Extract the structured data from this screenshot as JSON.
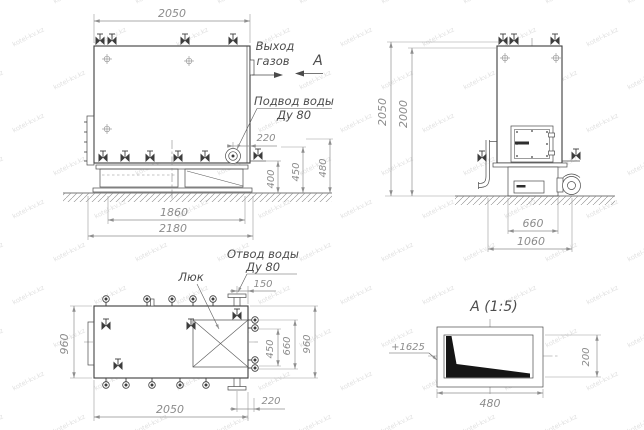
{
  "meta": {
    "type": "technical-drawing",
    "subject": "boiler three-view drawing",
    "language": "ru"
  },
  "colors": {
    "line": "#3d3d3d",
    "dimension": "#8f8f8f",
    "label": "#4d4d4d",
    "background": "#ffffff"
  },
  "watermark": {
    "text": "kotel-kv.kz"
  },
  "front_view": {
    "labels": {
      "gas_out_1": "Выход",
      "gas_out_2": "газов",
      "view_letter": "A",
      "water_in_1": "Подвод воды",
      "water_in_2": "Ду 80"
    },
    "dims": {
      "top_width": "2050",
      "inlet_offset": "220",
      "h400": "400",
      "h450": "450",
      "h480": "480",
      "base_width": "1860",
      "overall_width": "2180"
    }
  },
  "side_view": {
    "dims": {
      "total_height": "2050",
      "body_height": "2000",
      "base_width": "660",
      "overall_depth": "1060"
    }
  },
  "top_view": {
    "labels": {
      "hatch": "Люк",
      "water_out_1": "Отвод воды",
      "water_out_2": "Ду 80"
    },
    "dims": {
      "depth_left": "960",
      "outlet_offset": "150",
      "pitch_450": "450",
      "pitch_660": "660",
      "depth_right": "960",
      "length": "2050",
      "bottom_offset": "220"
    }
  },
  "detail_view": {
    "title": "A (1:5)",
    "dims": {
      "level": "+1625",
      "width": "480",
      "height": "200"
    }
  }
}
